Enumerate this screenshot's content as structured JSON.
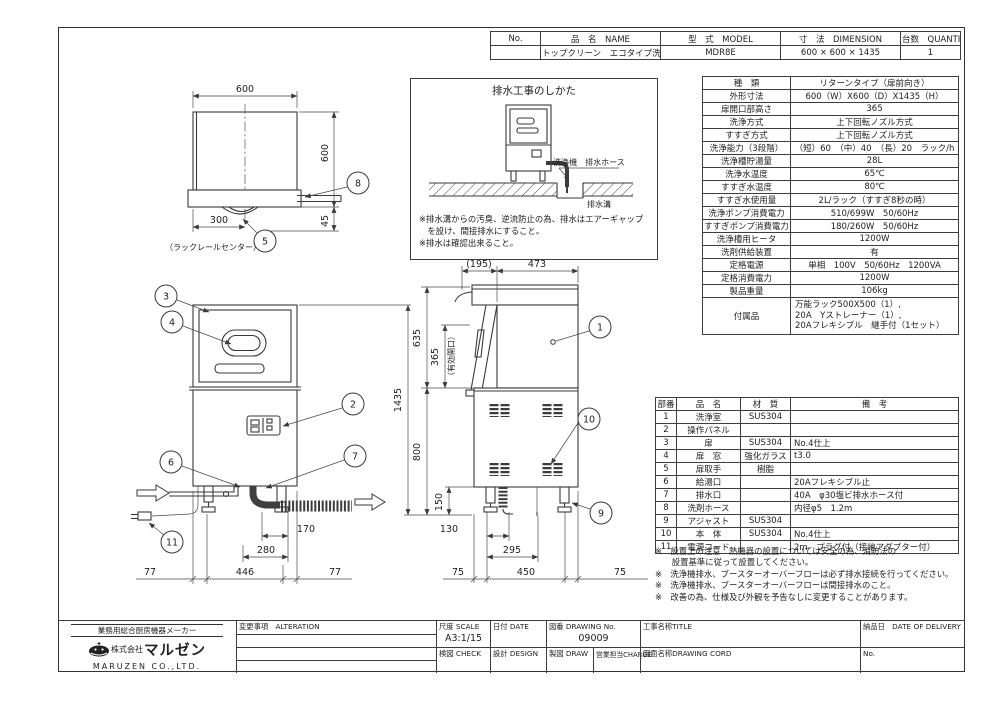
{
  "header_table": {
    "columns": {
      "no": "No.",
      "name": "品　名　NAME",
      "model": "型　式　MODEL",
      "dimension": "寸　法　DIMENSION",
      "quantity": "台数　QUANTITY"
    },
    "row": {
      "no": "",
      "name": "トップクリーン　エコタイプ洗浄機",
      "model": "MDR8E",
      "dimension": "600 × 600 × 1435",
      "quantity": "1"
    }
  },
  "spec": {
    "rows": [
      {
        "l": "種　類",
        "v": "リターンタイプ（扉前向き）"
      },
      {
        "l": "外形寸法",
        "v": "600（W）X600（D）X1435（H）"
      },
      {
        "l": "扉開口部高さ",
        "v": "365"
      },
      {
        "l": "洗浄方式",
        "v": "上下回転ノズル方式"
      },
      {
        "l": "すすぎ方式",
        "v": "上下回転ノズル方式"
      },
      {
        "l": "洗浄能力（3段階）",
        "v": "（短）60　（中）40　（長）20　ラック/h"
      },
      {
        "l": "洗浄槽貯湯量",
        "v": "28L"
      },
      {
        "l": "洗浄水温度",
        "v": "65℃"
      },
      {
        "l": "すすぎ水温度",
        "v": "80℃"
      },
      {
        "l": "すすぎ水使用量",
        "v": "2L/ラック（すすぎ8秒の時）"
      },
      {
        "l": "洗浄ポンプ消費電力",
        "v": "510/699W　50/60Hz"
      },
      {
        "l": "すすぎポンプ消費電力",
        "v": "180/260W　50/60Hz"
      },
      {
        "l": "洗浄槽用ヒータ",
        "v": "1200W"
      },
      {
        "l": "洗剤供給装置",
        "v": "有"
      },
      {
        "l": "定格電源",
        "v": "単相　100V　50/60Hz　1200VA"
      },
      {
        "l": "定格消費電力",
        "v": "1200W"
      },
      {
        "l": "製品重量",
        "v": "106kg"
      },
      {
        "l": "付属品",
        "v": "万能ラック500X500（1）,\n20A　Yストレーナー（1）,\n20Aフレキシブル　継手付（1セット）"
      }
    ]
  },
  "parts": {
    "headers": [
      "部番",
      "品　名",
      "材　質",
      "備　考"
    ],
    "rows": [
      [
        "1",
        "洗浄室",
        "SUS304",
        ""
      ],
      [
        "2",
        "操作パネル",
        "",
        ""
      ],
      [
        "3",
        "扉",
        "SUS304",
        "No.4仕上"
      ],
      [
        "4",
        "扉　窓",
        "強化ガラス",
        "t3.0"
      ],
      [
        "5",
        "扉取手",
        "樹脂",
        ""
      ],
      [
        "6",
        "給湯口",
        "",
        "20Aフレキシブル止"
      ],
      [
        "7",
        "排水口",
        "",
        "40A　φ30塩ビ排水ホース付"
      ],
      [
        "8",
        "洗剤ホース",
        "",
        "内径φ5　1.2m"
      ],
      [
        "9",
        "アジャスト",
        "SUS304",
        ""
      ],
      [
        "10",
        "本　体",
        "SUS304",
        "No.4仕上"
      ],
      [
        "11",
        "電源コード",
        "",
        "2m　プラグ付（接地アダプター付）"
      ]
    ]
  },
  "notes": [
    "※　設置上の注意　熱機器の設置については安全の為、消防法の",
    "　　設置基準に従って設置してください。",
    "※　洗浄機排水、ブースターオーバーフローは必ず排水接続を行ってください。",
    "※　洗浄機排水、ブースターオーバーフローは間接排水のこと。",
    "※　改善の為、仕様及び外観を予告なしに変更することがあります。"
  ],
  "drain_box": {
    "title": "排水工事のしかた",
    "hose_label": "洗浄機　排水ホース",
    "gutter_label": "排水溝",
    "notes": [
      "※排水溝からの汚臭、逆流防止の為、排水はエアーギャップ",
      "　を設け、間接排水にすること。",
      "※排水は確認出来ること。"
    ]
  },
  "dims": {
    "top_view": {
      "w": "600",
      "h": "600",
      "h45": "45",
      "rail": "300",
      "rail_note": "（ラックレールセンター）"
    },
    "front_view": {
      "d170": "170",
      "d280": "280",
      "l77": "77",
      "m446": "446",
      "r77": "77",
      "total": "1435"
    },
    "side_view": {
      "t195": "(195)",
      "t473": "473",
      "h635": "635",
      "h365": "365",
      "opening": "（有効開口）",
      "h800": "800",
      "h150": "150",
      "d130": "130",
      "d295": "295",
      "l75": "75",
      "m450": "450",
      "r75": "75"
    }
  },
  "balloons": {
    "b1": "1",
    "b2": "2",
    "b3": "3",
    "b4": "4",
    "b5": "5",
    "b6": "6",
    "b7": "7",
    "b8": "8",
    "b9": "9",
    "b10": "10",
    "b11": "11"
  },
  "company": {
    "slogan": "業務用総合厨房機器メーカー",
    "prefix": "株式会社",
    "name": "マルゼン",
    "en": "MARUZEN CO.,LTD."
  },
  "title_block": {
    "alteration": "変更事項　ALTERATION",
    "scale_label": "尺度 SCALE",
    "scale_value": "A3:1/15",
    "date_label": "日付 DATE",
    "check_label": "検図 CHECK",
    "design_label": "設計 DESIGN",
    "drawing_no_label": "図番 DRAWING No.",
    "drawing_no_value": "09009",
    "draw_label": "製図 DRAW",
    "charge_label": "営業担当CHARGE",
    "title_label": "工事名称TITLE",
    "cord_label": "図面名称DRAWING CORD",
    "delivery_label": "納品日　DATE OF DELIVERY",
    "no_label": "No."
  }
}
